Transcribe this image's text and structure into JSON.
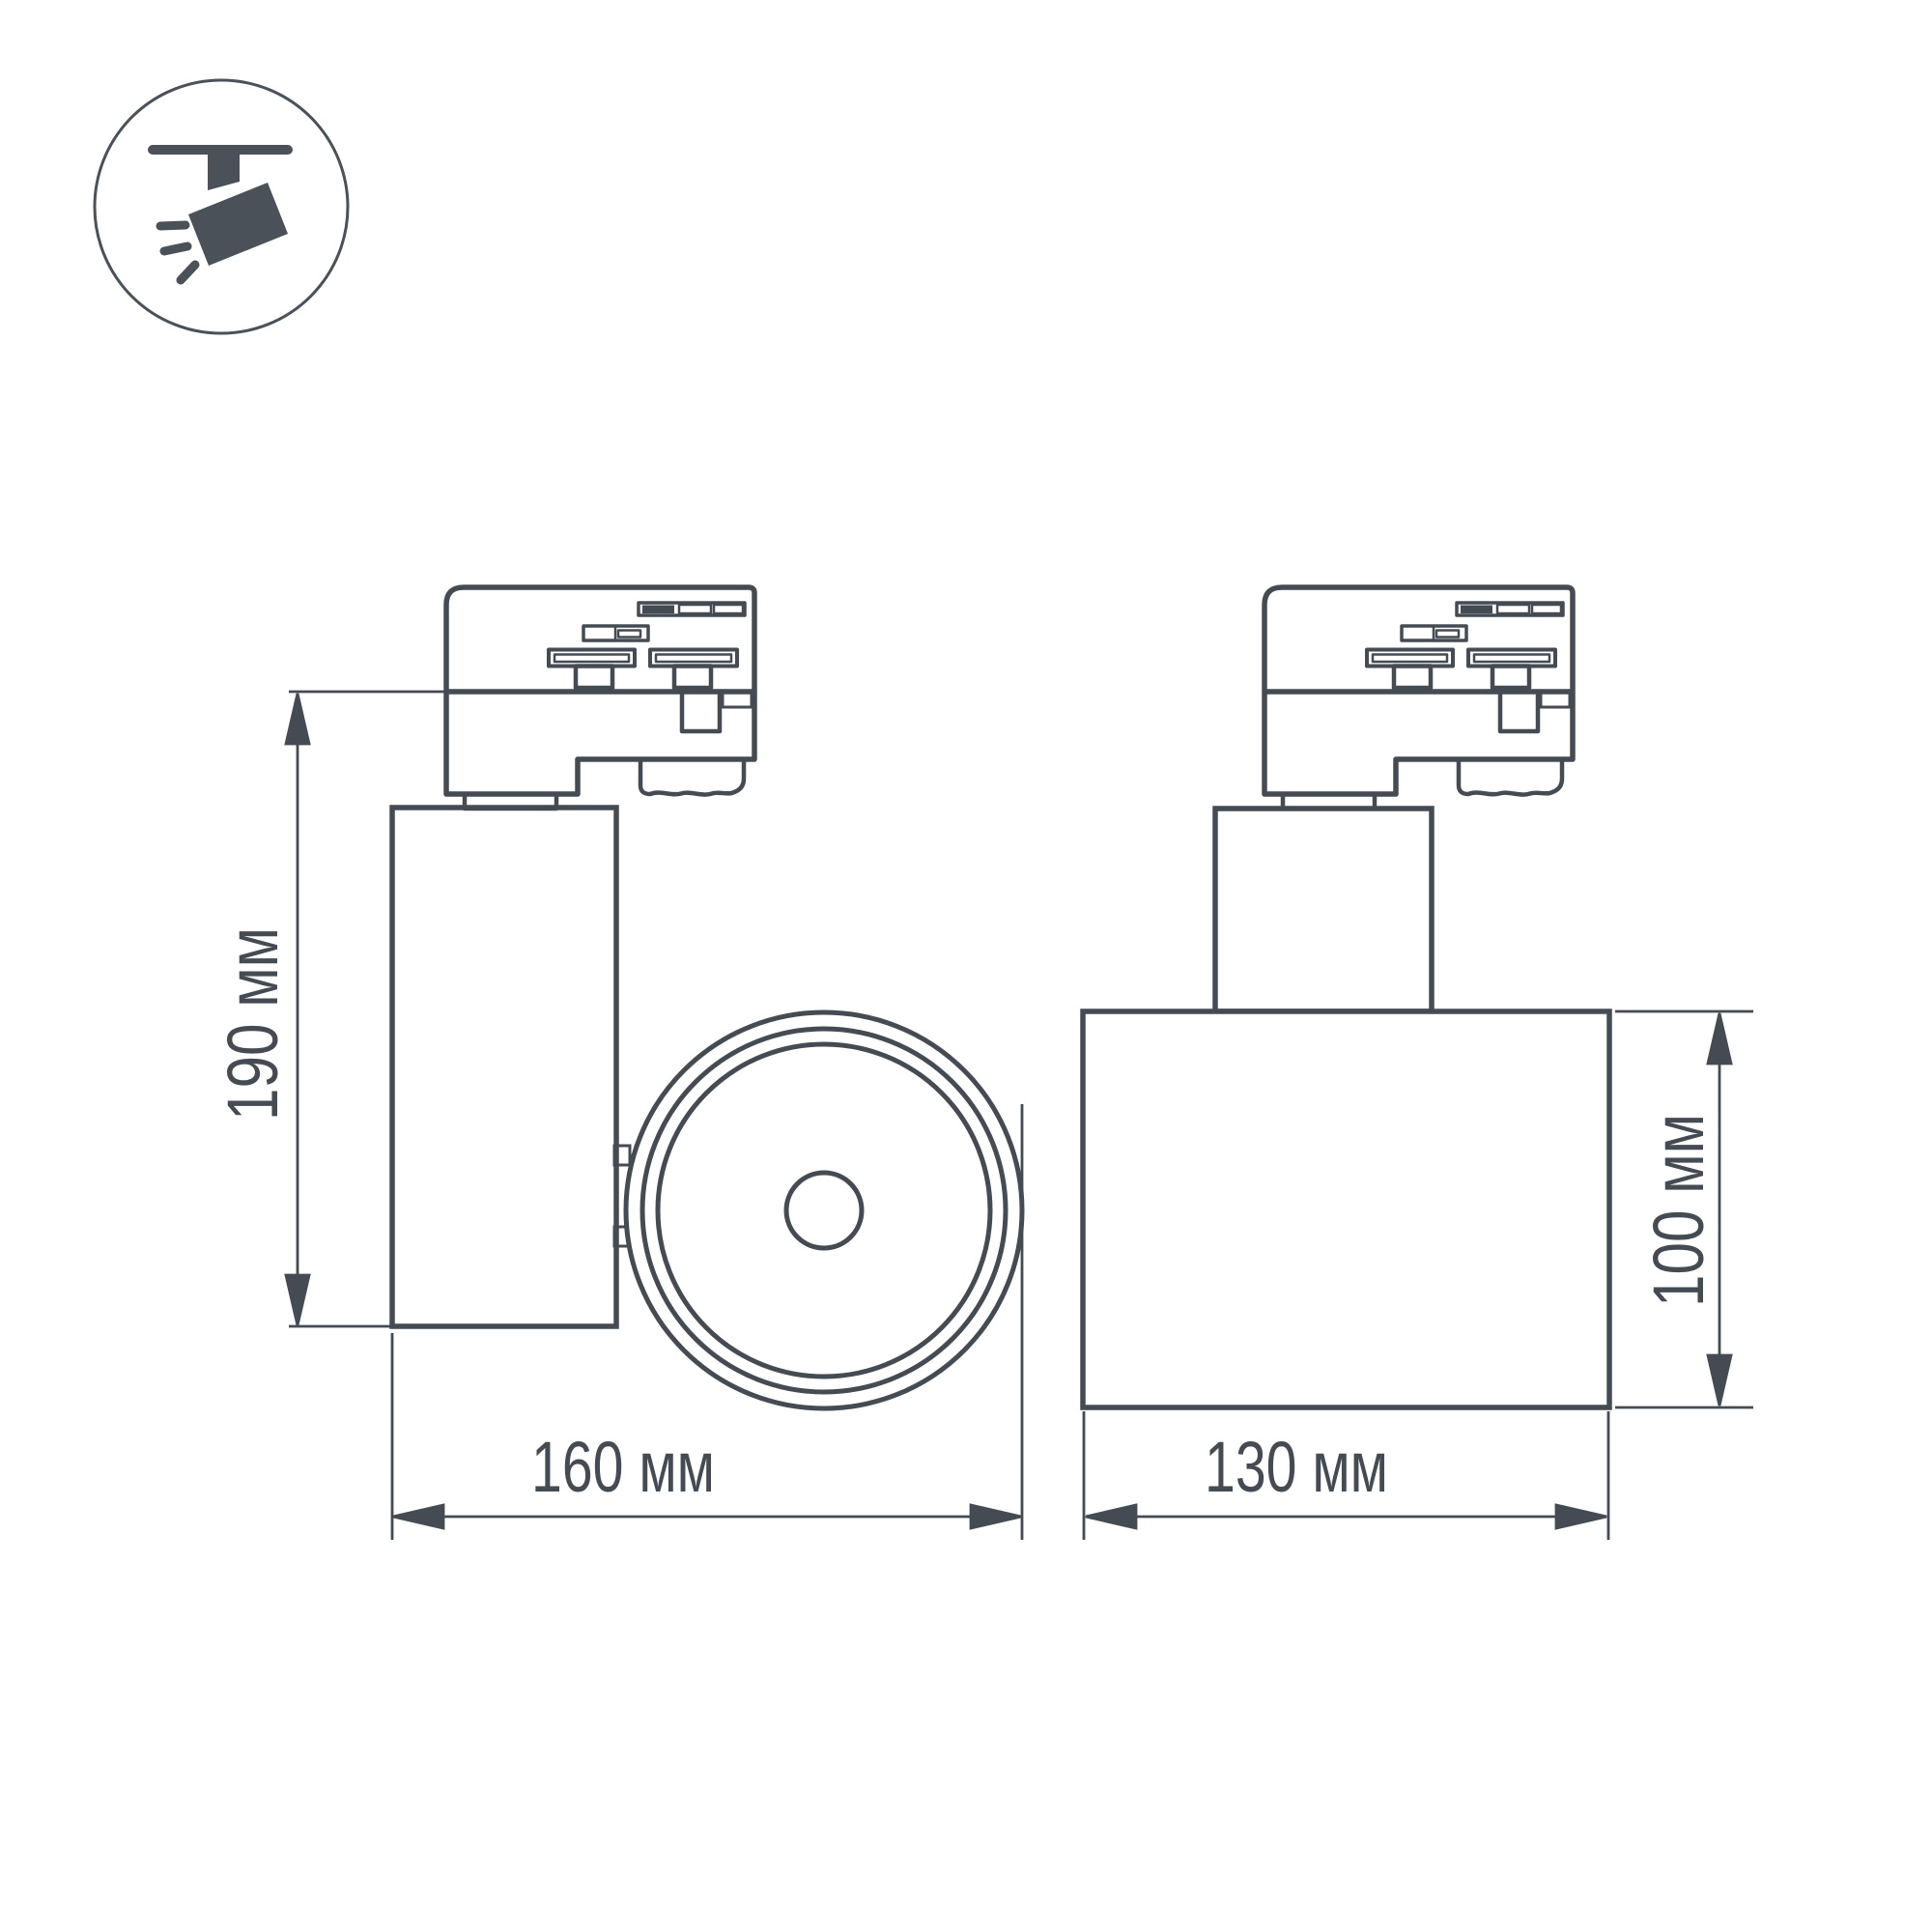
{
  "title": "Track spotlight dimensional drawing",
  "colors": {
    "ink": "#454b52",
    "icon_fill": "#4a5158",
    "background": "#ffffff"
  },
  "icon": {
    "name": "track-spotlight-pictogram"
  },
  "dimensions": {
    "side_height": {
      "label": "190 мм",
      "value": 190,
      "unit": "мм"
    },
    "side_length": {
      "label": "160 мм",
      "value": 160,
      "unit": "мм"
    },
    "front_length": {
      "label": "130 мм",
      "value": 130,
      "unit": "мм"
    },
    "front_diameter": {
      "label": "100 мм",
      "value": 100,
      "unit": "мм"
    }
  }
}
